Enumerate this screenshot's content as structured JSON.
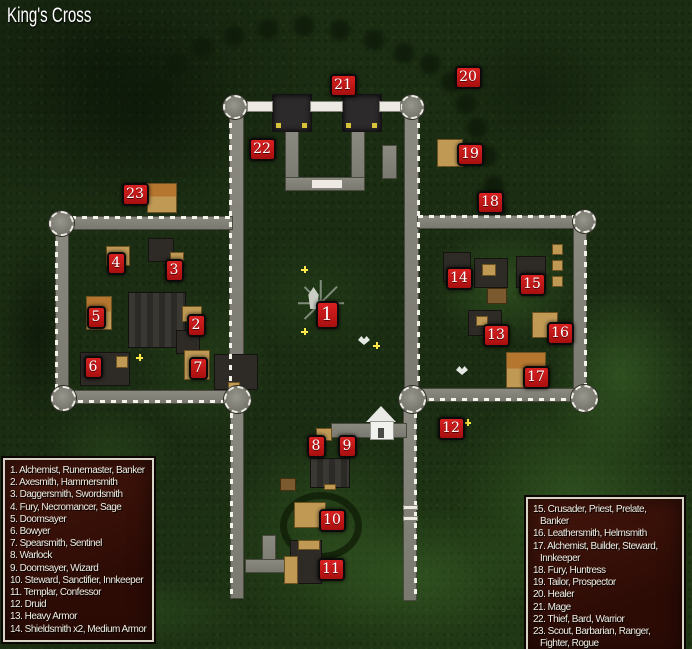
{
  "title": "King's Cross",
  "colors": {
    "marker_red": "#c41414",
    "legend_bg": "#38110a",
    "legend_border": "#d8d3c6",
    "forest_green": "#1b2d13",
    "road_gray": "#83827a"
  },
  "legend_left": [
    {
      "num": "1.",
      "label": "Alchemist, Runemaster, Banker"
    },
    {
      "num": "2.",
      "label": "Axesmith, Hammersmith"
    },
    {
      "num": "3.",
      "label": "Daggersmith, Swordsmith"
    },
    {
      "num": "4.",
      "label": "Fury, Necromancer, Sage"
    },
    {
      "num": "5.",
      "label": "Doomsayer"
    },
    {
      "num": "6.",
      "label": "Bowyer"
    },
    {
      "num": "7.",
      "label": "Spearsmith, Sentinel"
    },
    {
      "num": "8.",
      "label": "Warlock"
    },
    {
      "num": "9.",
      "label": "Doomsayer, Wizard"
    },
    {
      "num": "10.",
      "label": "Steward, Sanctifier, Innkeeper"
    },
    {
      "num": "11.",
      "label": "Templar, Confessor"
    },
    {
      "num": "12.",
      "label": "Druid"
    },
    {
      "num": "13.",
      "label": "Heavy Armor"
    },
    {
      "num": "14.",
      "label": "Shieldsmith x2, Medium Armor"
    }
  ],
  "legend_right": [
    {
      "num": "15.",
      "label": "Crusader, Priest, Prelate, Banker"
    },
    {
      "num": "16.",
      "label": "Leathersmith, Helmsmith"
    },
    {
      "num": "17.",
      "label": "Alchemist, Builder, Steward, Innkeeper"
    },
    {
      "num": "18.",
      "label": "Fury, Huntress"
    },
    {
      "num": "19.",
      "label": "Tailor, Prospector"
    },
    {
      "num": "20.",
      "label": "Healer"
    },
    {
      "num": "21.",
      "label": "Mage"
    },
    {
      "num": "22.",
      "label": "Thief, Bard, Warrior"
    },
    {
      "num": "23.",
      "label": "Scout, Barbarian, Ranger, Fighter, Rogue"
    }
  ],
  "markers": [
    {
      "n": "1",
      "x": 327,
      "y": 315
    },
    {
      "n": "2",
      "x": 196,
      "y": 325
    },
    {
      "n": "3",
      "x": 174,
      "y": 270
    },
    {
      "n": "4",
      "x": 116,
      "y": 263
    },
    {
      "n": "5",
      "x": 96,
      "y": 317
    },
    {
      "n": "6",
      "x": 93,
      "y": 367
    },
    {
      "n": "7",
      "x": 198,
      "y": 368
    },
    {
      "n": "8",
      "x": 316,
      "y": 446
    },
    {
      "n": "9",
      "x": 347,
      "y": 446
    },
    {
      "n": "10",
      "x": 332,
      "y": 520
    },
    {
      "n": "11",
      "x": 331,
      "y": 569
    },
    {
      "n": "12",
      "x": 451,
      "y": 428
    },
    {
      "n": "13",
      "x": 496,
      "y": 335
    },
    {
      "n": "14",
      "x": 459,
      "y": 278
    },
    {
      "n": "15",
      "x": 532,
      "y": 284
    },
    {
      "n": "16",
      "x": 560,
      "y": 333
    },
    {
      "n": "17",
      "x": 536,
      "y": 377
    },
    {
      "n": "18",
      "x": 490,
      "y": 202
    },
    {
      "n": "19",
      "x": 470,
      "y": 154
    },
    {
      "n": "20",
      "x": 468,
      "y": 77
    },
    {
      "n": "21",
      "x": 343,
      "y": 85
    },
    {
      "n": "22",
      "x": 262,
      "y": 149
    },
    {
      "n": "23",
      "x": 135,
      "y": 194
    }
  ]
}
